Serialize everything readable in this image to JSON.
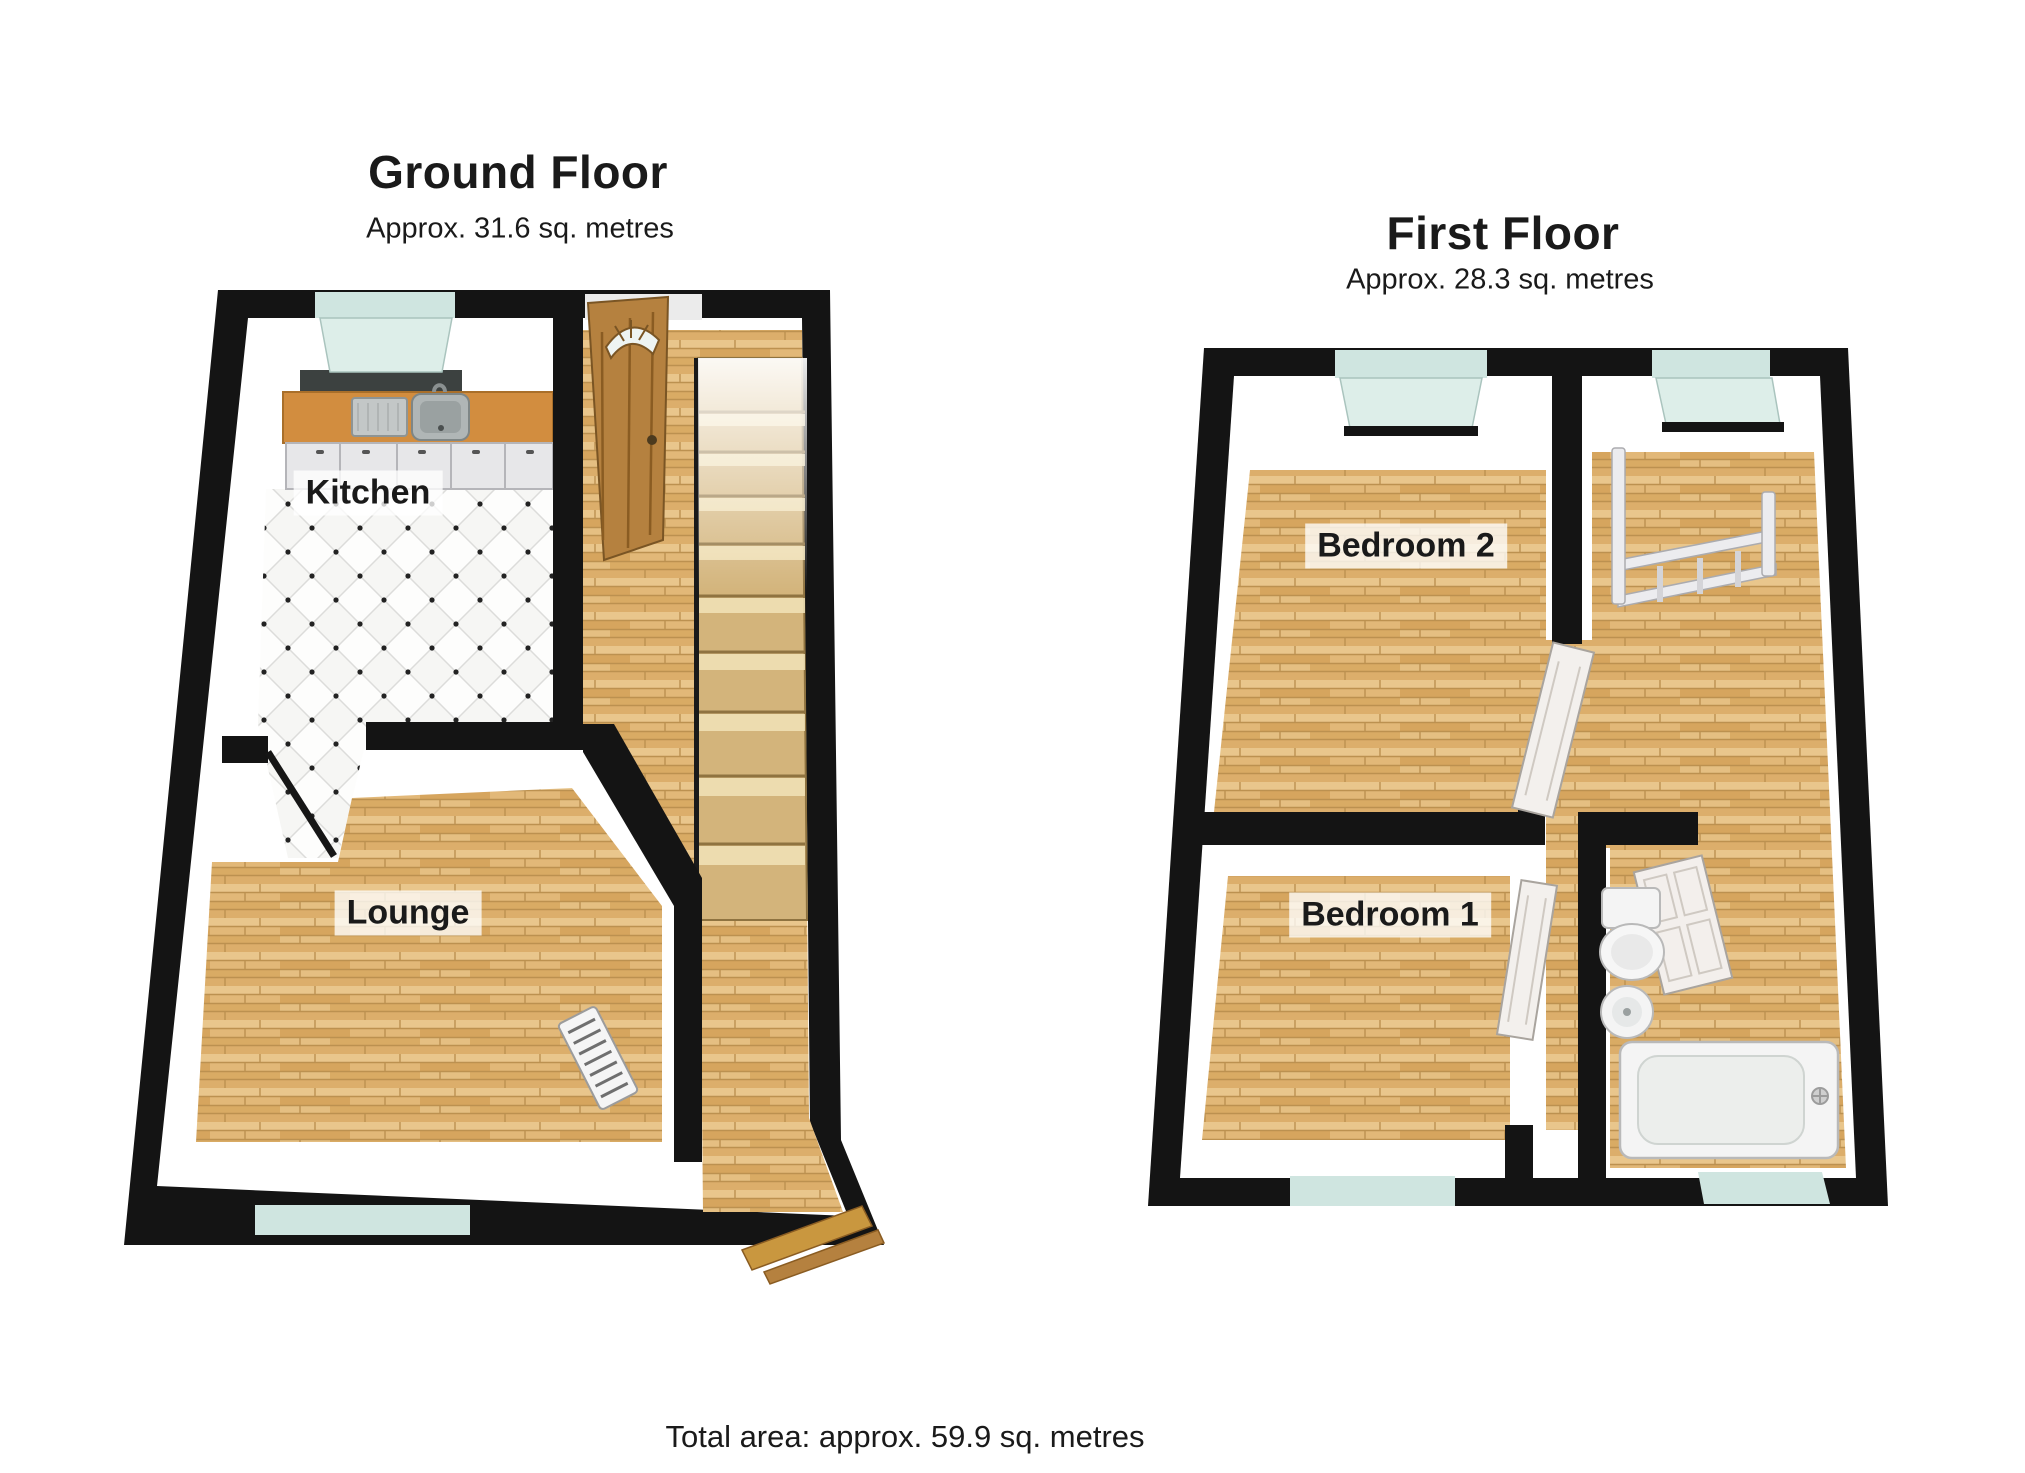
{
  "page": {
    "background_color": "#ffffff",
    "text_color": "#1a1a1a"
  },
  "ground_floor": {
    "title": "Ground Floor",
    "subtitle": "Approx.  31.6 sq. metres",
    "rooms": [
      {
        "label": "Kitchen",
        "floor_type": "tile"
      },
      {
        "label": "Lounge",
        "floor_type": "wood"
      }
    ],
    "features": [
      "kitchen-window",
      "kitchen-counter-with-sink",
      "kitchen-cabinets",
      "front-door",
      "staircase",
      "hallway",
      "open-interior-door",
      "lounge-window",
      "radiator"
    ]
  },
  "first_floor": {
    "title": "First Floor",
    "subtitle": "Approx.  28.3 sq. metres",
    "rooms": [
      {
        "label": "Bedroom 2",
        "floor_type": "wood"
      },
      {
        "label": "Bedroom 1",
        "floor_type": "wood"
      }
    ],
    "features": [
      "bedroom2-window",
      "landing-window",
      "stair-railing",
      "bedroom2-door",
      "bedroom1-door",
      "bathroom-door",
      "toilet",
      "wash-basin",
      "bathtub",
      "bedroom1-window",
      "bathroom-window"
    ]
  },
  "footer": {
    "total_area": "Total area: approx.  59.9 sq. metres"
  },
  "colors": {
    "wall": "#141414",
    "wood_floor": "#dfb475",
    "tile_floor": "#f6f6f4",
    "window_glass": "#cfe5e0",
    "counter_wood": "#d28d3f",
    "front_door_wood": "#b5813f",
    "stairs": "#d3b47b",
    "fixtures_white": "#f4f4f4",
    "label_background": "rgba(255,255,255,0.78)"
  }
}
